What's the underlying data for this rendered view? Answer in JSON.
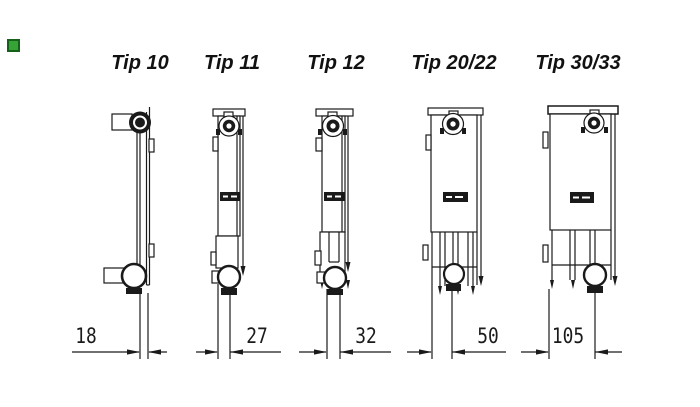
{
  "colors": {
    "ink": "#1a1a1a",
    "background": "#ffffff",
    "marker_green": "#36a336"
  },
  "radiators": [
    {
      "label": "Tip 10",
      "depth_mm": "18"
    },
    {
      "label": "Tip 11",
      "depth_mm": "27"
    },
    {
      "label": "Tip 12",
      "depth_mm": "32"
    },
    {
      "label": "Tip 20/22",
      "depth_mm": "50"
    },
    {
      "label": "Tip 30/33",
      "depth_mm": "105"
    }
  ]
}
